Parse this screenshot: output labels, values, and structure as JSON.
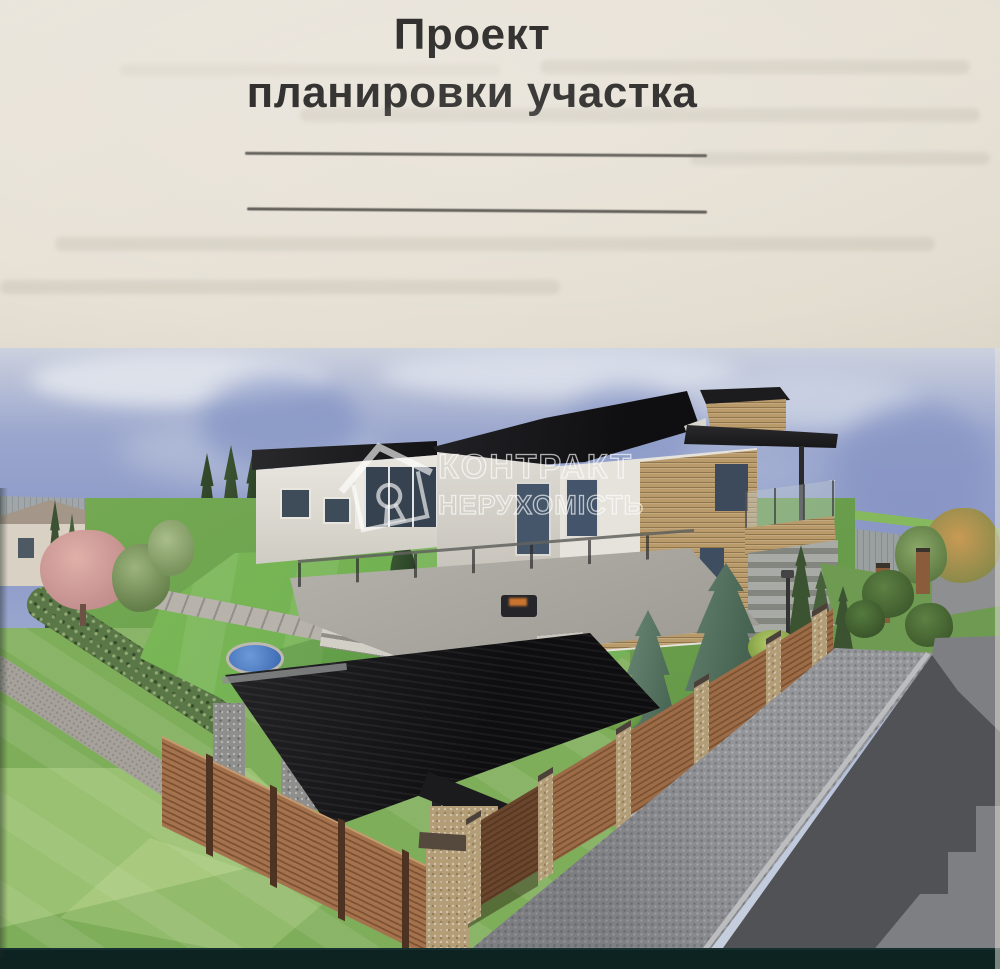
{
  "document": {
    "title_line1": "Проект",
    "title_line2": "планировки участка",
    "blank_line_count": "2"
  },
  "watermark": {
    "brand_line1": "КОНТРАКТ",
    "brand_line2": "НЕРУХОМІСТЬ",
    "logo": "house-keyhole-icon"
  },
  "colors": {
    "paper": "#e7e1d6",
    "title_text": "#1d1c1a",
    "rule_line": "#57544e",
    "sky_blue": "#8a97c6",
    "cloud_white": "#dfe3ec",
    "lawn_green": "#74b455",
    "outside_lawn_green": "#7fae5a",
    "roof_black": "#1a1a1c",
    "brick_tan": "#b99b6b",
    "fence_wood_brown": "#9c6b47",
    "stone_pillar_tan": "#b39d77",
    "pond_blue": "#4a7fd0",
    "driveway_gray": "#95969a",
    "road_gray": "#7e7f82",
    "bottom_strip": "#0c2322",
    "watermark_white": "#ffffff"
  }
}
